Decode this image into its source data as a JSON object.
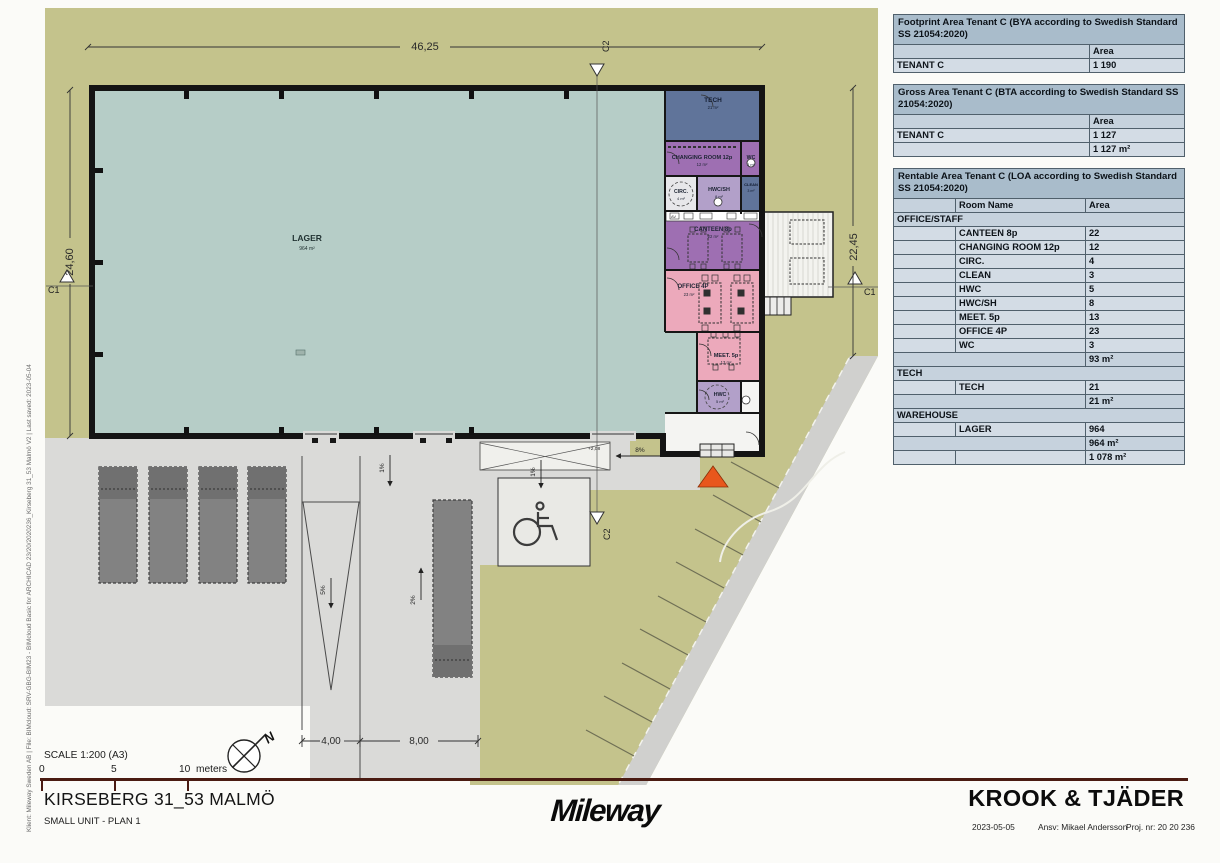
{
  "colors": {
    "site_green": "#c4c38c",
    "yard_gray": "#dadad8",
    "warehouse_teal": "#b6cdc7",
    "tech_slate": "#60749a",
    "staff_purple": "#9e6fb2",
    "wet_lilac": "#b2a0c9",
    "office_pink": "#eca9bb",
    "entrance_orange": "#e8571c",
    "table_title": "#a9bccb",
    "scale_bar": "#4a1b12"
  },
  "plan": {
    "rooms": {
      "lager": {
        "name": "LAGER",
        "area": "964 m²"
      },
      "tech": {
        "name": "TECH",
        "area": "21 m²"
      },
      "changing": {
        "name": "CHANGING ROOM 12p",
        "area": "12 m²"
      },
      "wc": {
        "name": "WC",
        "area": "3 m²"
      },
      "circ": {
        "name": "CIRC.",
        "area": "4 m²"
      },
      "hwcsh": {
        "name": "HWC/SH",
        "area": "8 m²"
      },
      "clean": {
        "name": "CLEAN",
        "area": "3 m²"
      },
      "canteen": {
        "name": "CANTEEN 8p",
        "area": "22 m²"
      },
      "office": {
        "name": "OFFICE 4P",
        "area": "23 m²"
      },
      "meet": {
        "name": "MEET. 5p",
        "area": "13 m²"
      },
      "hwc": {
        "name": "HWC",
        "area": "5 m²"
      }
    },
    "dimensions": {
      "top": "46,25",
      "left": "24,60",
      "right": "22,45",
      "bottom_a": "4,00",
      "bottom_b": "8,00"
    },
    "markers": {
      "c1": "C1",
      "c2": "C2"
    },
    "slopes": {
      "dock": "1%",
      "pad": "1%",
      "ramp": "5%",
      "dock2": "2%",
      "entrance": "8%"
    },
    "levels": {
      "a": "+2,08",
      "b": "+1,78"
    },
    "fixtures": {
      "av": "AV"
    },
    "north": "N"
  },
  "panel": {
    "tables": [
      {
        "title": "Footprint Area Tenant C (BYA according to Swedish Standard SS 21054:2020)",
        "area_header": "Area",
        "rows": [
          {
            "name": "TENANT C",
            "area": "1 190"
          }
        ]
      },
      {
        "title": "Gross Area Tenant C (BTA according to Swedish Standard SS 21054:2020)",
        "area_header": "Area",
        "rows": [
          {
            "name": "TENANT C",
            "area": "1 127"
          }
        ],
        "total": "1 127 m²"
      },
      {
        "title": "Rentable Area Tenant C (LOA according to Swedish Standard SS 21054:2020)",
        "room_header": "Room Name",
        "area_header": "Area",
        "groups": [
          {
            "name": "OFFICE/STAFF",
            "rows": [
              {
                "name": "CANTEEN 8p",
                "area": "22"
              },
              {
                "name": "CHANGING ROOM 12p",
                "area": "12"
              },
              {
                "name": "CIRC.",
                "area": "4"
              },
              {
                "name": "CLEAN",
                "area": "3"
              },
              {
                "name": "HWC",
                "area": "5"
              },
              {
                "name": "HWC/SH",
                "area": "8"
              },
              {
                "name": "MEET. 5p",
                "area": "13"
              },
              {
                "name": "OFFICE 4P",
                "area": "23"
              },
              {
                "name": "WC",
                "area": "3"
              }
            ],
            "subtotal": "93 m²"
          },
          {
            "name": "TECH",
            "rows": [
              {
                "name": "TECH",
                "area": "21"
              }
            ],
            "subtotal": "21 m²"
          },
          {
            "name": "WAREHOUSE",
            "rows": [
              {
                "name": "LAGER",
                "area": "964"
              }
            ],
            "subtotal": "964 m²"
          }
        ],
        "total": "1 078 m²"
      }
    ]
  },
  "footer": {
    "scale_label": "SCALE 1:200 (A3)",
    "scale_ticks": {
      "t0": "0",
      "t5": "5",
      "t10": "10",
      "unit": "meters"
    },
    "project_title": "KIRSEBERG 31_53 MALMÖ",
    "sheet_title": "SMALL UNIT - PLAN 1",
    "logo": "Mileway",
    "firm": "KROOK & TJÄDER",
    "date": "2023-05-05",
    "responsible": "Ansv: Mikael Andersson",
    "project_no": "Proj. nr: 20 20 236"
  },
  "margin_note": "Klient: Mileway Sweden AB     |     File: BIMcloud: SRV-GBG-BIM23 - BIMcloud Basic for ARCHICAD 23/20/2020236_Kirseberg 31_53 Malmö V2     |     Last saved: 2023-05-04"
}
